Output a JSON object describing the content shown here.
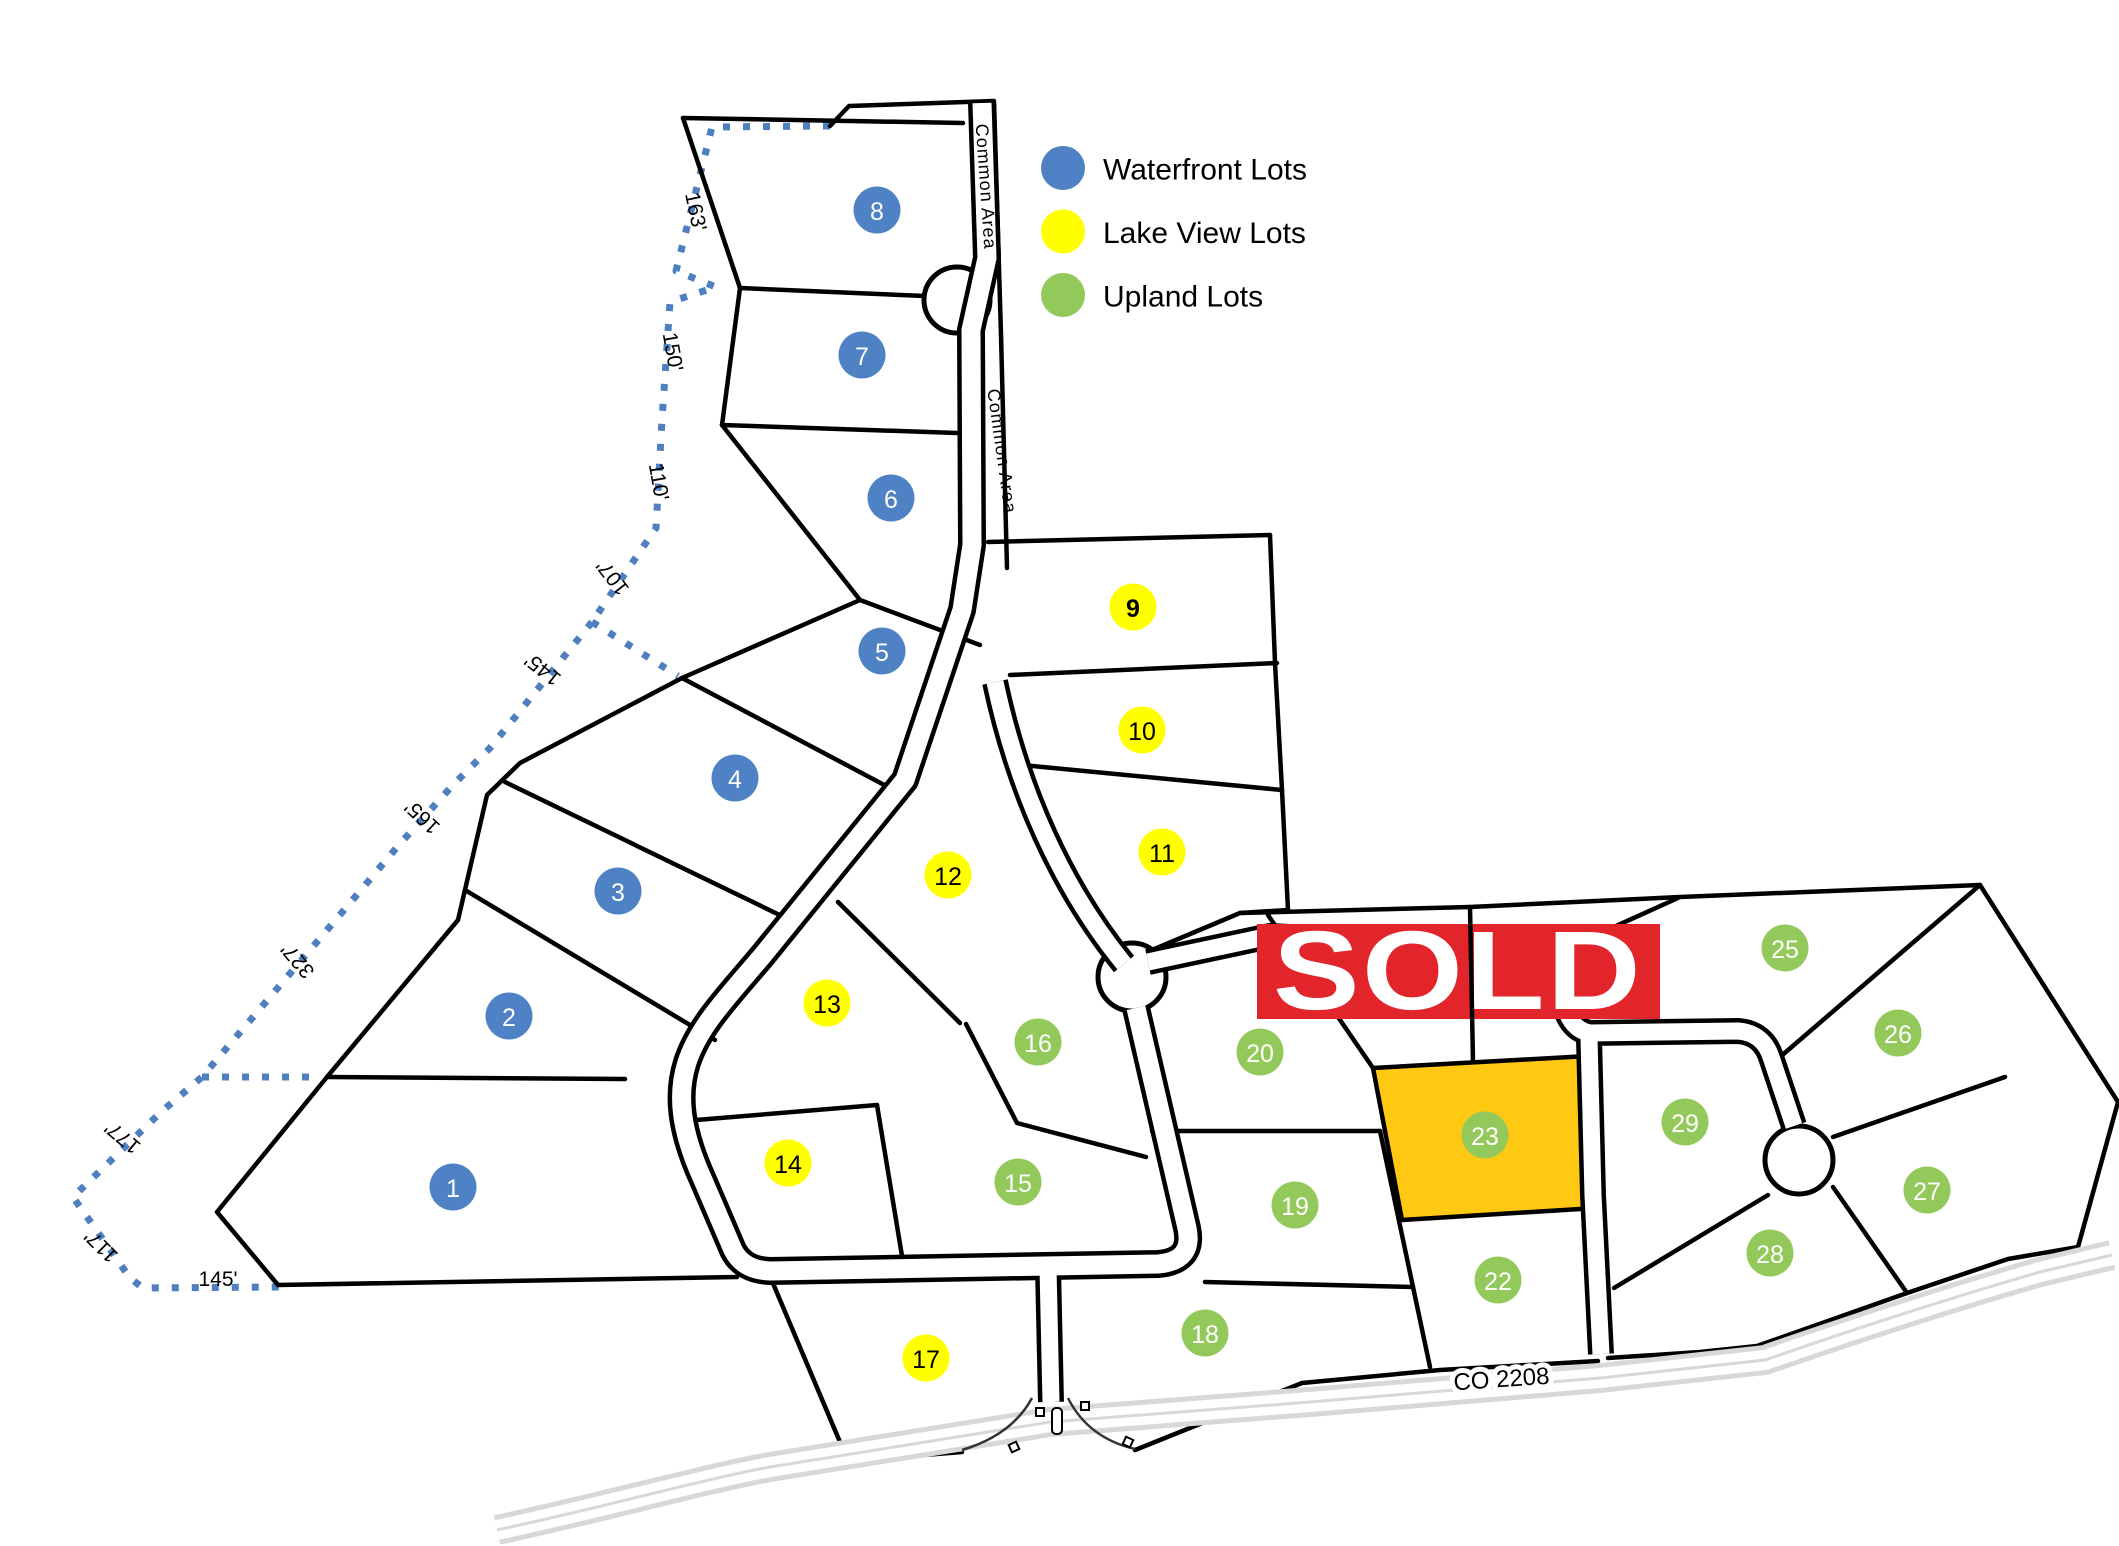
{
  "legend": {
    "items": [
      {
        "id": "waterfront",
        "label": "Waterfront Lots",
        "color": "#4E82C4",
        "text_color": "#ffffff"
      },
      {
        "id": "lakeview",
        "label": "Lake View Lots",
        "color": "#FFFF00",
        "text_color": "#000000"
      },
      {
        "id": "upland",
        "label": "Upland Lots",
        "color": "#92C95A",
        "text_color": "#ffffff"
      }
    ]
  },
  "lots": [
    {
      "number": "1",
      "type": "waterfront",
      "x": 453,
      "y": 1187
    },
    {
      "number": "2",
      "type": "waterfront",
      "x": 509,
      "y": 1016
    },
    {
      "number": "3",
      "type": "waterfront",
      "x": 618,
      "y": 891
    },
    {
      "number": "4",
      "type": "waterfront",
      "x": 735,
      "y": 778
    },
    {
      "number": "5",
      "type": "waterfront",
      "x": 882,
      "y": 651
    },
    {
      "number": "6",
      "type": "waterfront",
      "x": 891,
      "y": 498
    },
    {
      "number": "7",
      "type": "waterfront",
      "x": 862,
      "y": 355
    },
    {
      "number": "8",
      "type": "waterfront",
      "x": 877,
      "y": 210
    },
    {
      "number": "9",
      "type": "lakeview",
      "x": 1133,
      "y": 607,
      "bold": true
    },
    {
      "number": "10",
      "type": "lakeview",
      "x": 1142,
      "y": 730
    },
    {
      "number": "11",
      "type": "lakeview",
      "x": 1162,
      "y": 852
    },
    {
      "number": "12",
      "type": "lakeview",
      "x": 948,
      "y": 875
    },
    {
      "number": "13",
      "type": "lakeview",
      "x": 827,
      "y": 1003
    },
    {
      "number": "14",
      "type": "lakeview",
      "x": 788,
      "y": 1163
    },
    {
      "number": "15",
      "type": "upland",
      "x": 1018,
      "y": 1182
    },
    {
      "number": "16",
      "type": "upland",
      "x": 1038,
      "y": 1042
    },
    {
      "number": "17",
      "type": "lakeview",
      "x": 926,
      "y": 1358
    },
    {
      "number": "18",
      "type": "upland",
      "x": 1205,
      "y": 1333
    },
    {
      "number": "19",
      "type": "upland",
      "x": 1295,
      "y": 1205
    },
    {
      "number": "20",
      "type": "upland",
      "x": 1260,
      "y": 1052
    },
    {
      "number": "22",
      "type": "upland",
      "x": 1498,
      "y": 1280
    },
    {
      "number": "23",
      "type": "upland",
      "x": 1485,
      "y": 1135
    },
    {
      "number": "25",
      "type": "upland",
      "x": 1785,
      "y": 948
    },
    {
      "number": "26",
      "type": "upland",
      "x": 1898,
      "y": 1033
    },
    {
      "number": "27",
      "type": "upland",
      "x": 1927,
      "y": 1190
    },
    {
      "number": "28",
      "type": "upland",
      "x": 1770,
      "y": 1253
    },
    {
      "number": "29",
      "type": "upland",
      "x": 1685,
      "y": 1122
    }
  ],
  "sold_banner": {
    "text": "SOLD",
    "color": "#E2242B",
    "text_color": "#FFFFFF"
  },
  "highlighted_lot": {
    "number": "23",
    "fill": "#FFC812"
  },
  "road_labels": [
    {
      "text": "Common Area",
      "x": 980,
      "y": 187,
      "rotation": 86,
      "style": "roadlabel"
    },
    {
      "text": "Common Area",
      "x": 996,
      "y": 452,
      "rotation": 82,
      "style": "roadlabel"
    },
    {
      "text": "CO 2208",
      "x": 1502,
      "y": 1387,
      "rotation": -4,
      "style": "halo"
    }
  ],
  "measurements": [
    {
      "text": "163'",
      "x": 689,
      "y": 213,
      "rotation": 78
    },
    {
      "text": "150'",
      "x": 666,
      "y": 353,
      "rotation": 80
    },
    {
      "text": "110'",
      "x": 652,
      "y": 483,
      "rotation": 80
    },
    {
      "text": "107'",
      "x": 618,
      "y": 573,
      "rotation": -128
    },
    {
      "text": "145'",
      "x": 547,
      "y": 664,
      "rotation": -142
    },
    {
      "text": "165'",
      "x": 427,
      "y": 812,
      "rotation": -137
    },
    {
      "text": "327'",
      "x": 303,
      "y": 956,
      "rotation": -130
    },
    {
      "text": "177'",
      "x": 127,
      "y": 1132,
      "rotation": -140
    },
    {
      "text": "117'",
      "x": 106,
      "y": 1241,
      "rotation": -135
    },
    {
      "text": "145'",
      "x": 218,
      "y": 1286,
      "rotation": 0
    }
  ],
  "map_colors": {
    "boundary_dotted": "#4E7FBF",
    "county_road_gray": "#D8D8D8",
    "parcel_line": "#000000"
  }
}
